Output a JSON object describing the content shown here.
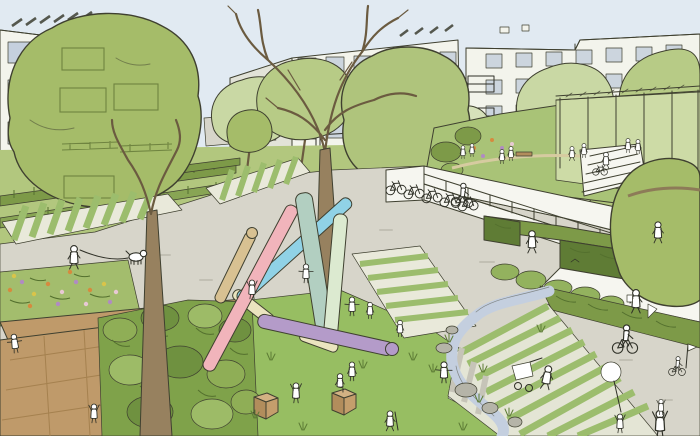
{
  "scene": {
    "type": "illustration",
    "style": "hand-drawn architectural masterplan sketch",
    "description": "Perspective sketch of a car-free residential courtyard: white apartment blocks with balconies and solar panels, large trees, private gardens, a central paved plaza with bicycle ramp and racks, a raised roof-terrace garden with pergola, a playground lawn with colored balance beams, wooden cubes, a small stream, striped walkways and many people.",
    "palette": {
      "sky": "#e1eaf2",
      "building": "#f3f4ec",
      "building_shade": "#e2e3d8",
      "window": "#c5d0de",
      "window_glass": "#ccd5de",
      "courtyard": "#b2c77e",
      "hedge_olive": "#7d9a48",
      "hedge_mid": "#88a554",
      "hedge_dark": "#5f7c35",
      "tree_olive": "#a5bc69",
      "tree_olive2": "#afc47c",
      "tree_mid": "#b7cb86",
      "tree_light": "#c9d8a4",
      "tree_pale": "#d6e1ba",
      "pergola_green": "#cddba6",
      "terrace_green": "#a9c377",
      "shrub": "#93b25e",
      "bush": "#7fa24a",
      "grass": "#97be62",
      "paving": "#d7d5ca",
      "paving_dark": "#c6c4b8",
      "stripe_pale": "#e9e9da",
      "stripe_base": "#e4e5d5",
      "stripe_green": "#9cbd6d",
      "deck": "#bf9a6a",
      "deck_side": "#a5814f",
      "trunk": "#97815f",
      "stream": "#c4cfdf",
      "rock": "#b5b4a8",
      "wall": "#f6f6f0",
      "flowerbed": "#a3bd6d",
      "beam_pink": "#f1b4bb",
      "beam_teal": "#b2cfc1",
      "beam_celery": "#dcead0",
      "beam_cyan": "#90d2e6",
      "beam_purple": "#b49bc9",
      "beam_tan": "#d8c192",
      "beam_cream": "#eae4bf",
      "figure": "#ffffff",
      "car": "#f8f8f3",
      "flower_orange": "#d68a3e",
      "flower_purple": "#b08bc2",
      "flower_yellow": "#d9c44a",
      "flower_pink": "#e8c9d4"
    },
    "elements": [
      {
        "name": "sky",
        "label": "Sky"
      },
      {
        "name": "apartment-building-left",
        "label": "Apartment building (left)"
      },
      {
        "name": "apartment-building-center",
        "label": "Apartment building (center)"
      },
      {
        "name": "apartment-building-right",
        "label": "Apartment building (right)"
      },
      {
        "name": "solar-panels",
        "label": "Rooftop solar panels"
      },
      {
        "name": "balcony",
        "label": "Balconies with planting"
      },
      {
        "name": "private-garden-hedges",
        "label": "Private garden hedge rows"
      },
      {
        "name": "car",
        "label": "Parked car"
      },
      {
        "name": "street-trees",
        "label": "Street trees"
      },
      {
        "name": "big-tree-left",
        "label": "Large tree (left)"
      },
      {
        "name": "big-tree-center",
        "label": "Large tree (center)"
      },
      {
        "name": "big-tree-right-edge",
        "label": "Large tree (right edge)"
      },
      {
        "name": "bare-tree",
        "label": "Bare sketch trees"
      },
      {
        "name": "central-plaza",
        "label": "Central paved plaza"
      },
      {
        "name": "striped-walkway",
        "label": "Striped green walkways"
      },
      {
        "name": "bicycle-ramp",
        "label": "Ramp to bicycle parking"
      },
      {
        "name": "bicycle-racks",
        "label": "Parked bicycles"
      },
      {
        "name": "roof-terrace-garden",
        "label": "Raised terrace garden"
      },
      {
        "name": "pergola",
        "label": "Pergola"
      },
      {
        "name": "terrace-stairs",
        "label": "Terrace stairs"
      },
      {
        "name": "hedge-walls",
        "label": "Hedge-topped walls"
      },
      {
        "name": "playground-lawn",
        "label": "Playground lawn"
      },
      {
        "name": "balance-beams",
        "label": "Colored balance beams"
      },
      {
        "name": "wooden-cubes",
        "label": "Wooden play cubes"
      },
      {
        "name": "stream",
        "label": "Small stream with rocks"
      },
      {
        "name": "timber-deck",
        "label": "Timber deck"
      },
      {
        "name": "flower-bed",
        "label": "Flower bed"
      },
      {
        "name": "people",
        "label": "People: children playing, dog walker, cyclists, parents, stroller, toddler on tricycle"
      }
    ]
  }
}
